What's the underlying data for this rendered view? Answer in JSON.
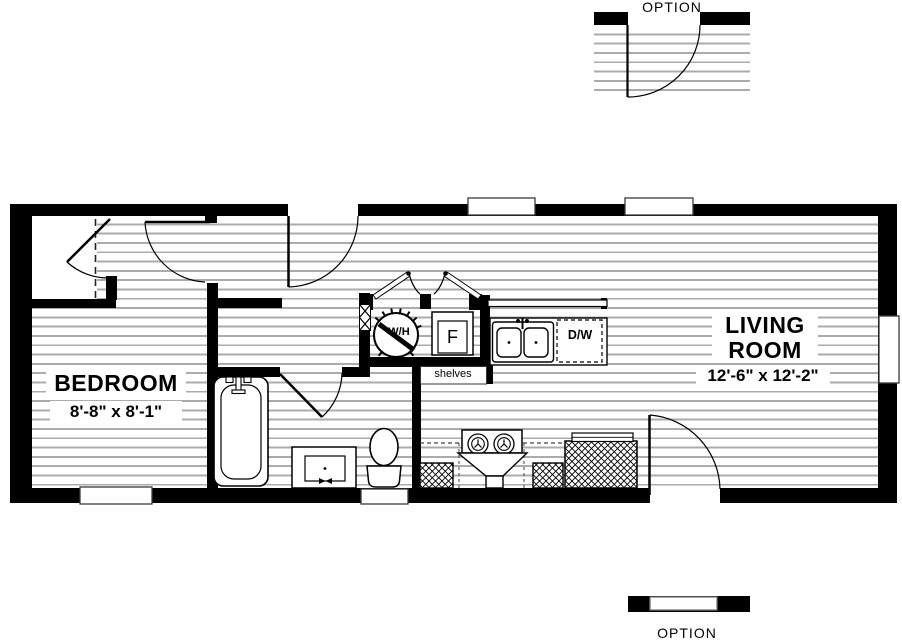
{
  "floor_plan": {
    "rooms": {
      "bedroom": {
        "name": "BEDROOM",
        "dimensions": "8'-8\" x  8'-1\""
      },
      "living_room": {
        "line1": "LIVING",
        "line2": "ROOM",
        "dimensions": "12'-6\" x  12'-2\""
      }
    },
    "fixtures": {
      "water_heater": "W/H",
      "furnace": "F",
      "dishwasher": "D/W",
      "shelves": "shelves"
    },
    "options": {
      "top": "OPTION",
      "bottom": "OPTION"
    },
    "colors": {
      "wall": "#000000",
      "siding_line": "#ababab",
      "background": "#ffffff",
      "text": "#000000"
    }
  }
}
